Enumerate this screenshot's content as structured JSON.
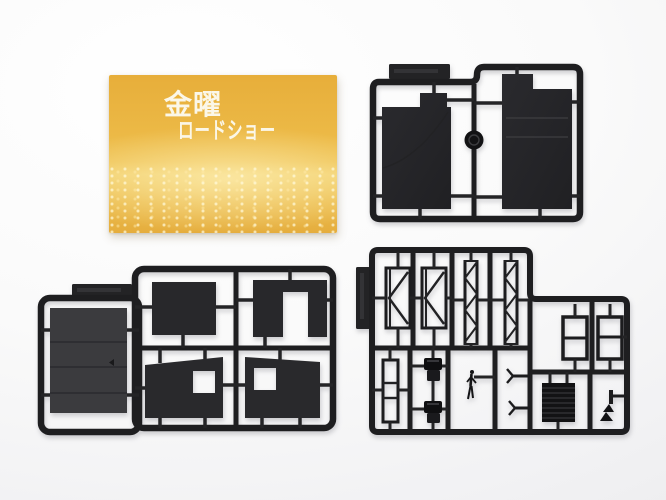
{
  "photo": {
    "card": {
      "logo_line1": "金曜",
      "logo_line2": "ロードショー",
      "background_color": "#ecb946",
      "logo_color": "#fbf7e8"
    },
    "colors": {
      "backdrop_top": "#ffffff",
      "backdrop_bottom": "#e9e9eb",
      "sprue_plastic": "#1e1e20",
      "panel_dark": "#26262a",
      "panel_gray": "#3b3b3e"
    },
    "sprues": [
      {
        "id": "sprue-large-panels",
        "parts": "two large dark roof panels, round disc, molded label tag"
      },
      {
        "id": "sprue-wall-panels",
        "parts": "planked wall, flat wall panels, two walls with window openings"
      },
      {
        "id": "sprue-detail-parts",
        "parts": "side braces, lattice trusses, window frames, ladder frame, chairs, figure, shutter panel, small fittings"
      }
    ]
  }
}
